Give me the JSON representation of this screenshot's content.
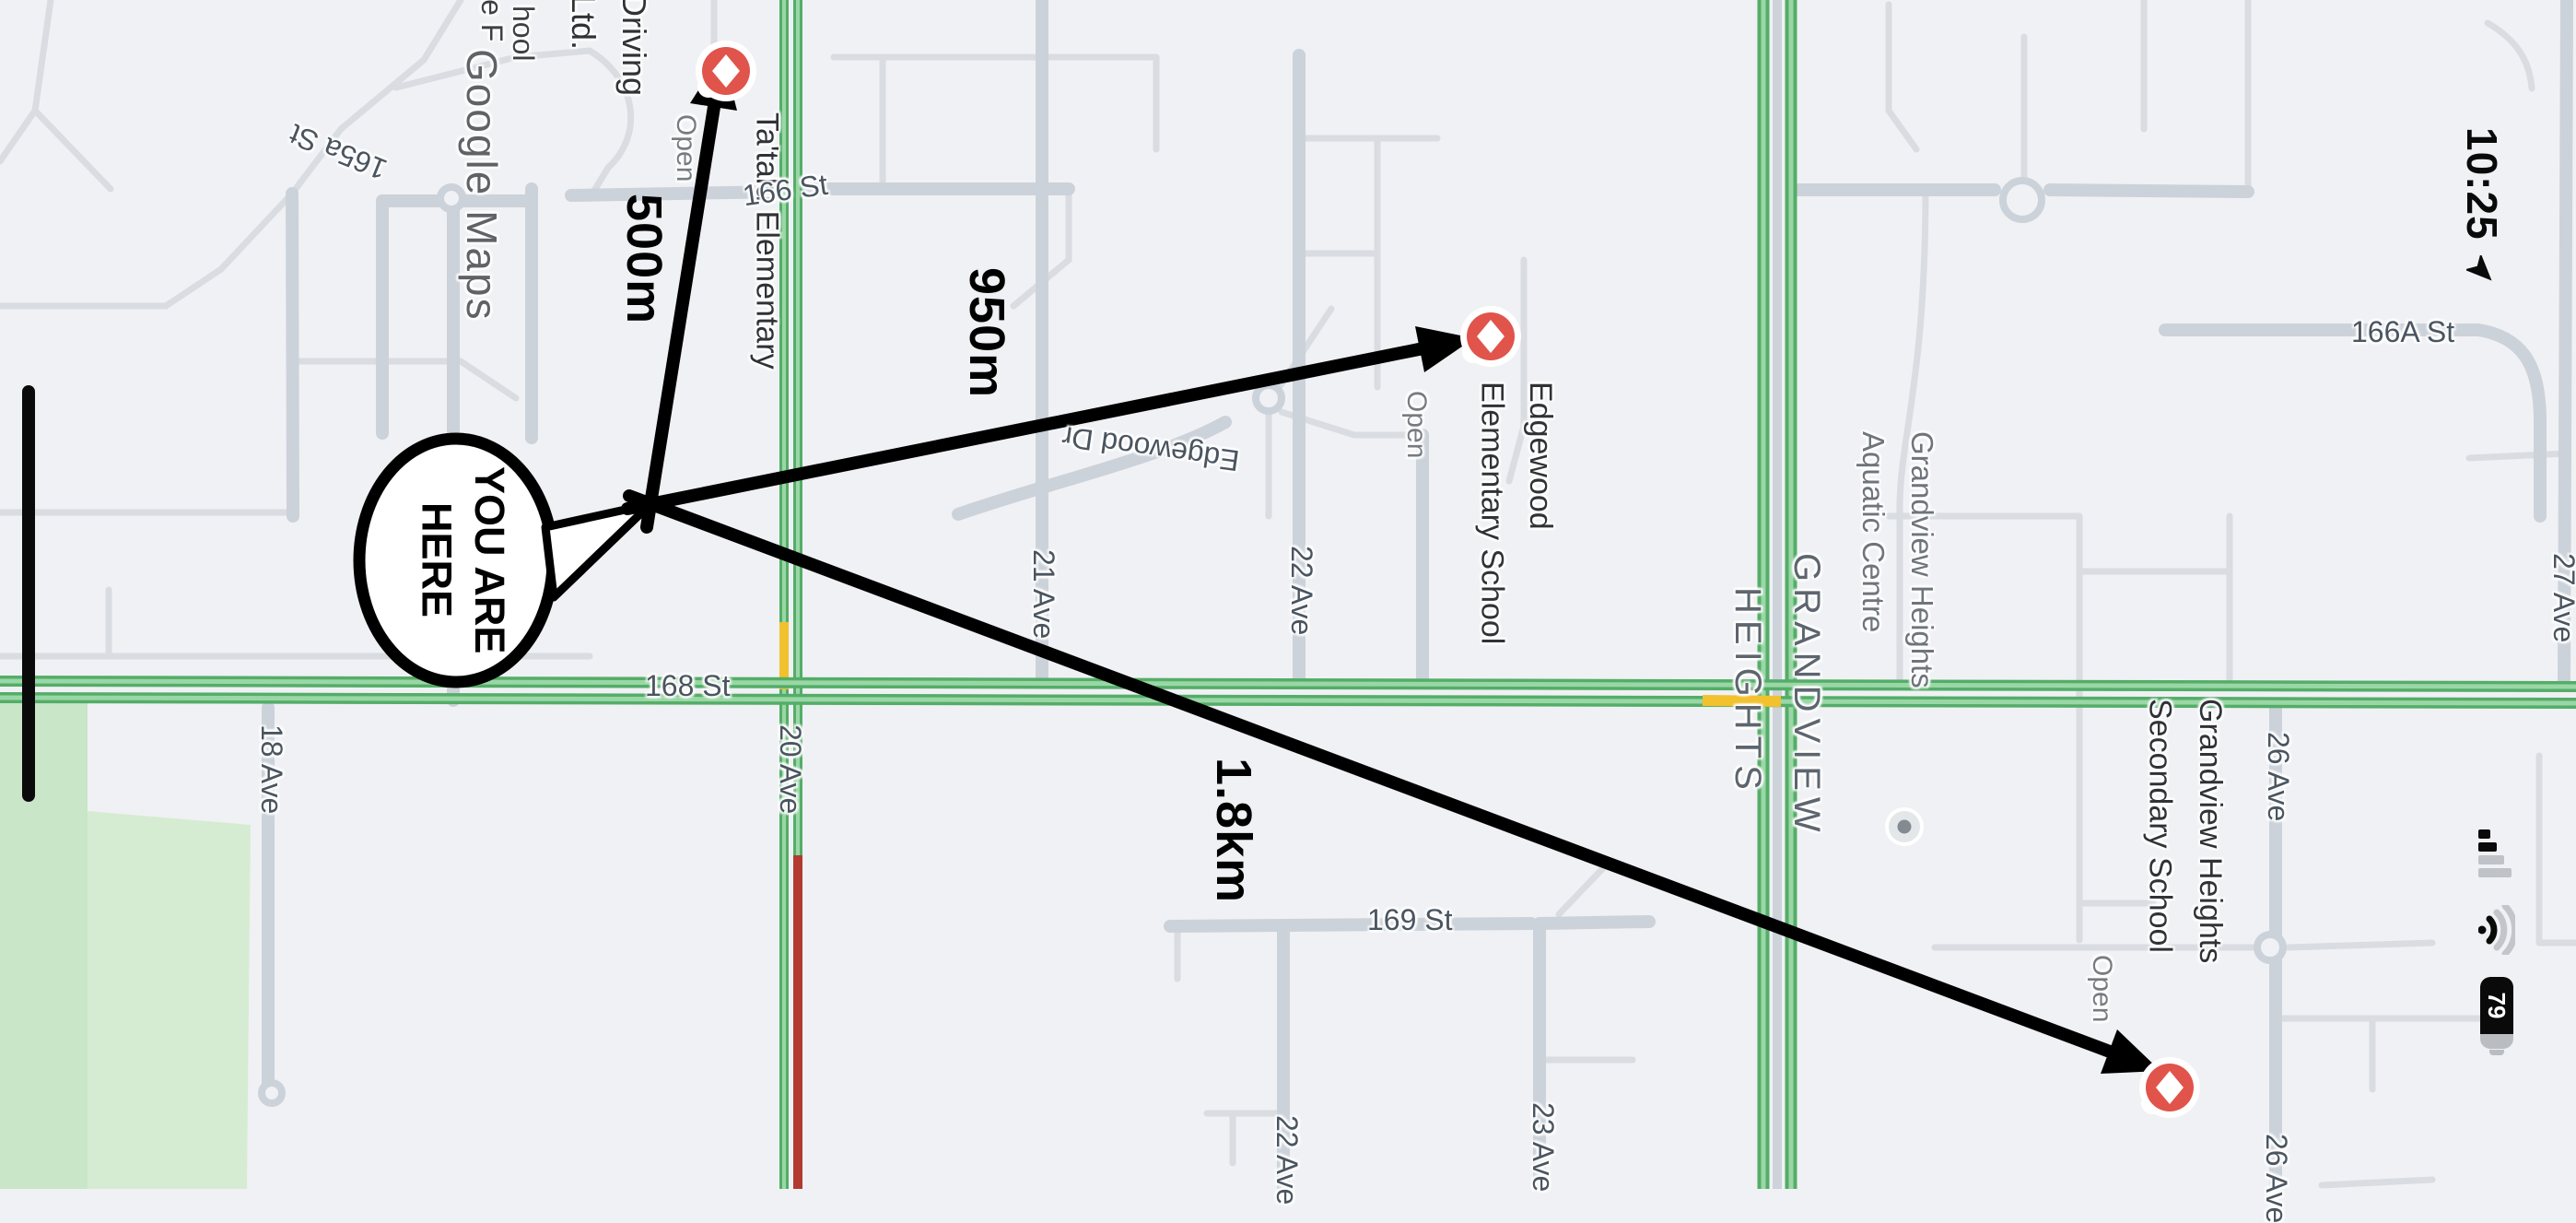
{
  "status_bar": {
    "time": "10:25",
    "location_icon": "navigation-arrow-icon",
    "cellular_icon": "cellular-signal-icon (2 of 4 bars)",
    "wifi_icon": "wifi-icon",
    "battery_percent": "79"
  },
  "watermark": {
    "text": "Google Maps"
  },
  "annotation": {
    "bubble": {
      "line1": "YOU ARE",
      "line2": "HERE"
    },
    "distances": {
      "d500": {
        "text": "500m"
      },
      "d950": {
        "text": "950m"
      },
      "d18": {
        "text": "1.8km"
      }
    }
  },
  "pois": {
    "tatalu": {
      "name": "Ta'talu Elementary",
      "status": "Open",
      "marker": "school-marker-icon"
    },
    "edgewood": {
      "name": "Edgewood\nElementary School",
      "status": "Open",
      "marker": "school-marker-icon"
    },
    "secondary": {
      "name": "Grandview Heights\nSecondary School",
      "status": "Open",
      "marker": "school-marker-icon"
    },
    "aquatic": {
      "name": "Grandview Heights\nAquatic Centre",
      "marker": "poi-dot-icon"
    },
    "driving": {
      "line1": "Driving",
      "line2": "Ltd."
    },
    "frag_leF": {
      "text": "le F"
    },
    "frag_hool": {
      "text": "hool"
    }
  },
  "area_labels": {
    "grandview": {
      "line1": "GRANDVIEW",
      "line2": "HEIGHTS"
    }
  },
  "streets": {
    "s165a": {
      "text": "165a St"
    },
    "s166": {
      "text": "166 St"
    },
    "s166a": {
      "text": "166A St"
    },
    "s168": {
      "text": "168 St"
    },
    "s169": {
      "text": "169 St"
    },
    "a18": {
      "text": "18 Ave"
    },
    "a20": {
      "text": "20 Ave"
    },
    "a21": {
      "text": "21 Ave"
    },
    "a22": {
      "text": "22 Ave"
    },
    "a22b": {
      "text": "22 Ave"
    },
    "a23": {
      "text": "23 Ave"
    },
    "a26": {
      "text": "26 Ave"
    },
    "a26b": {
      "text": "26 Ave"
    },
    "a27": {
      "text": "27 Ave"
    },
    "edr": {
      "text": "Edgewood Dr"
    }
  },
  "colors": {
    "map_background": "#f0f1f4",
    "traffic_green": "#54ad68",
    "traffic_yellow": "#f2c12e",
    "traffic_red": "#b33a31",
    "park_green": "#c9e6c8",
    "marker_red": "#e0544b",
    "annotation_black": "#000000"
  }
}
